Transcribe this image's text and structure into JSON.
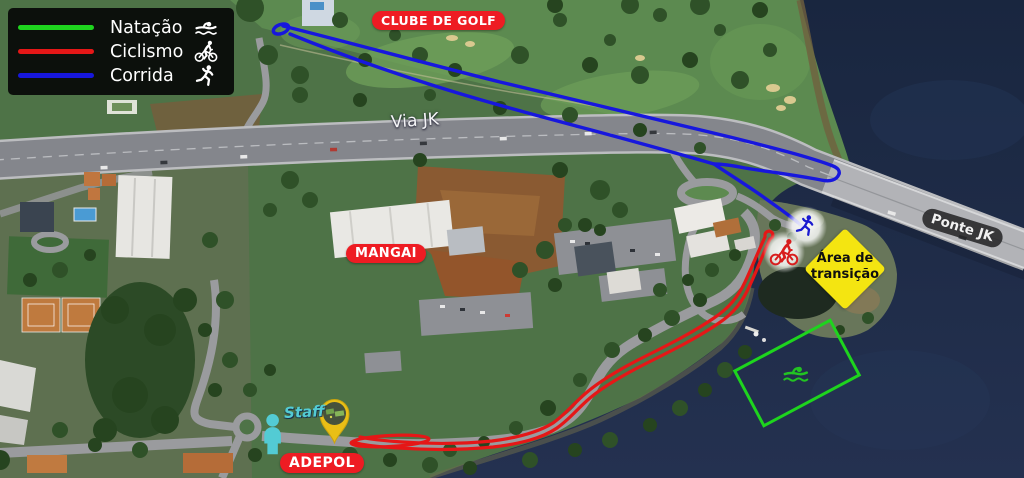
{
  "legend": {
    "items": [
      {
        "id": "natacao",
        "label": "Natação",
        "color": "#1ed41e",
        "icon": "swimmer-icon"
      },
      {
        "id": "ciclismo",
        "label": "Ciclismo",
        "color": "#e51717",
        "icon": "cyclist-icon"
      },
      {
        "id": "corrida",
        "label": "Corrida",
        "color": "#1717dd",
        "icon": "runner-icon"
      }
    ]
  },
  "labels": {
    "clube_de_golf": "CLUBE DE GOLF",
    "via_jk": "Via JK",
    "mangai": "MANGAI",
    "ponte_jk": "Ponte JK",
    "area_transicao_line1": "Área de",
    "area_transicao_line2": "transição",
    "adepol": "ADEPOL",
    "staff": "Staff"
  },
  "routes": {
    "natacao": {
      "name": "Natação",
      "color": "#1ed41e",
      "shape": "swim-area-rectangle-in-lake"
    },
    "ciclismo": {
      "name": "Ciclismo",
      "color": "#e51717",
      "shape": "out-and-back-coastal-road"
    },
    "corrida": {
      "name": "Corrida",
      "color": "#1717dd",
      "shape": "out-and-back-along-via-jk"
    }
  },
  "markers": {
    "transition_area": {
      "color": "#f4e511",
      "text_color": "#101010"
    },
    "runner": {
      "icon": "runner-icon",
      "color": "#1b1bd0"
    },
    "cyclist": {
      "icon": "cyclist-icon",
      "color": "#d81d1d"
    },
    "swimmer": {
      "icon": "swimmer-icon",
      "color": "#22c322"
    },
    "staff_person": {
      "icon": "person-icon",
      "color": "#53cbd4"
    },
    "vehicle_pin": {
      "icon": "map-pin-icon",
      "color": "#e9bf16"
    }
  },
  "colors": {
    "label_pill_red": "#ee1c23",
    "label_pill_dark": "rgba(38,38,40,0.88)",
    "water": "#1c2a46",
    "legend_bg": "rgba(5,5,5,0.9)"
  }
}
